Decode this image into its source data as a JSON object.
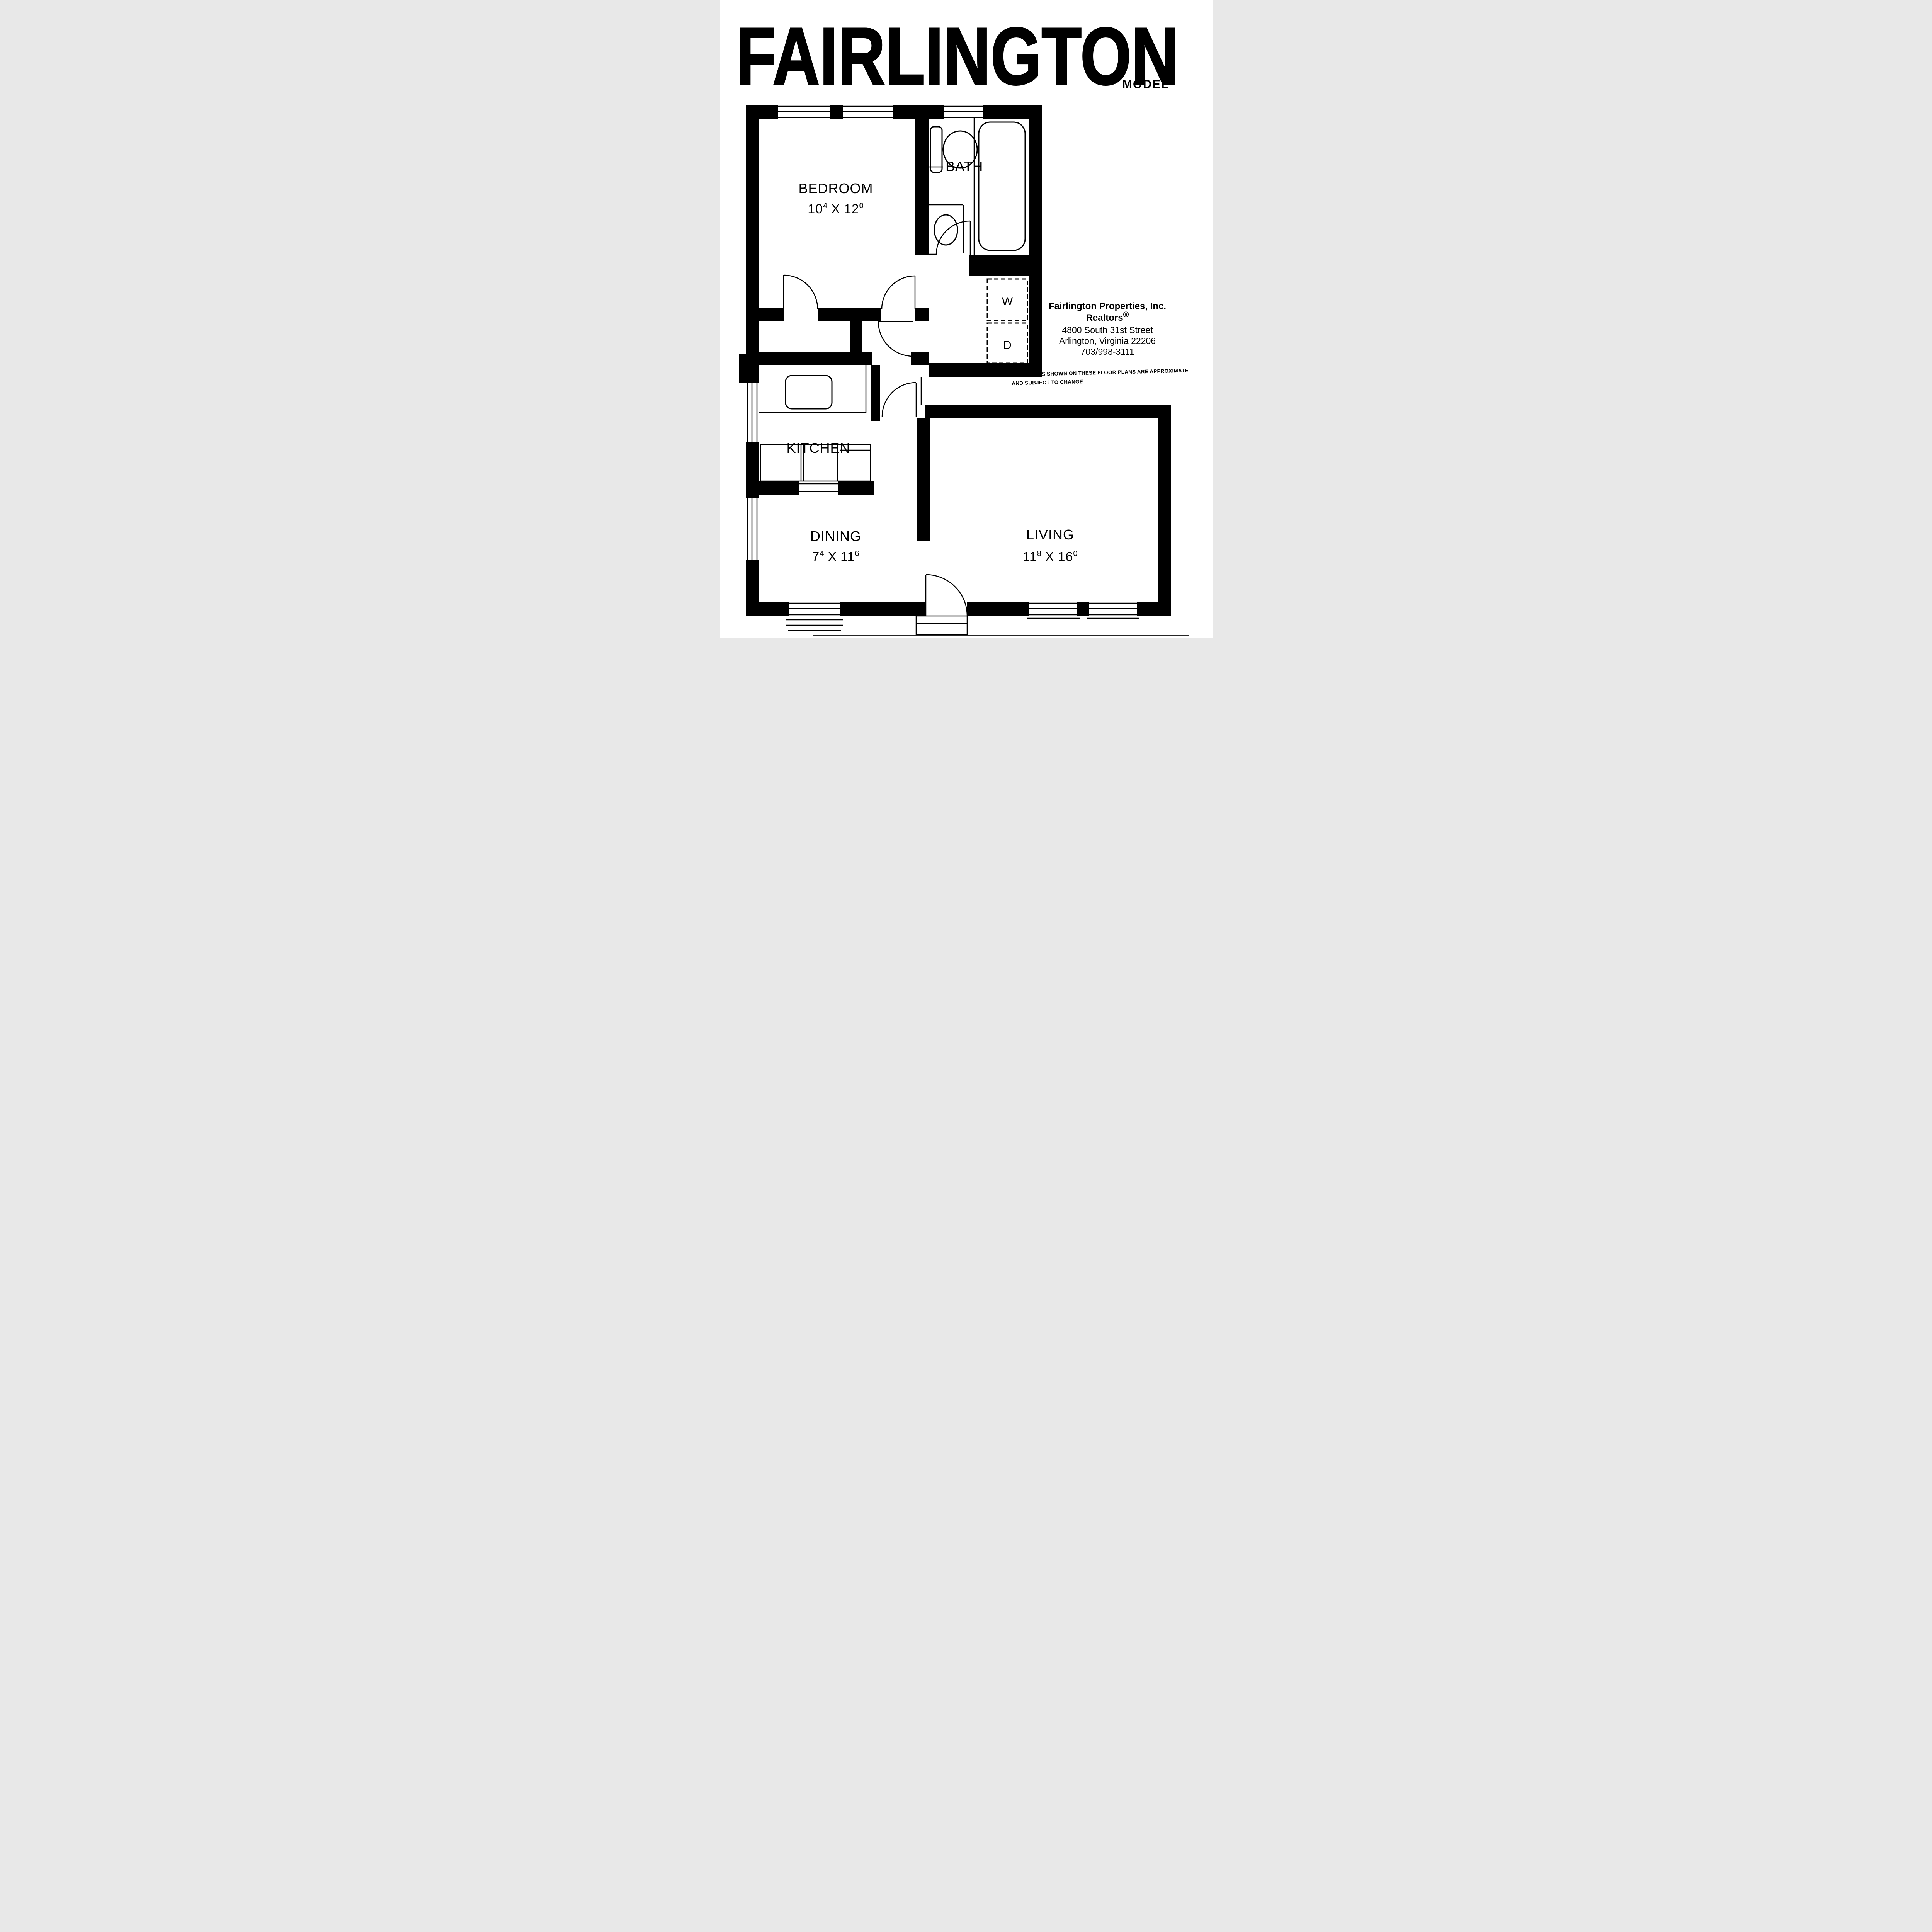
{
  "page": {
    "title": "FAIRLINGTON",
    "subtitle": "MODEL",
    "paper_color": "#ffffff",
    "ink_color": "#000000"
  },
  "realtor": {
    "name": "Fairlington Properties, Inc.",
    "tagline": "Realtors",
    "registered_mark": "®",
    "address_line1": "4800 South 31st Street",
    "address_line2": "Arlington, Virginia 22206",
    "phone": "703/998-3111"
  },
  "disclaimer": {
    "line1": "DIMENSIONS SHOWN ON THESE FLOOR PLANS ARE APPROXIMATE",
    "line2": "AND SUBJECT TO CHANGE"
  },
  "rooms": {
    "bedroom": {
      "label": "BEDROOM",
      "dim": {
        "a": "10",
        "asup": "4",
        "sep": "X",
        "b": "12",
        "bsup": "0"
      }
    },
    "bath": {
      "label": "BATH"
    },
    "kitchen": {
      "label": "KITCHEN"
    },
    "dining": {
      "label": "DINING",
      "dim": {
        "a": "7",
        "asup": "4",
        "sep": "X",
        "b": "11",
        "bsup": "6"
      }
    },
    "living": {
      "label": "LIVING",
      "dim": {
        "a": "11",
        "asup": "8",
        "sep": "X",
        "b": "16",
        "bsup": "0"
      }
    },
    "laundry": {
      "washer": "W",
      "dryer": "D"
    }
  }
}
